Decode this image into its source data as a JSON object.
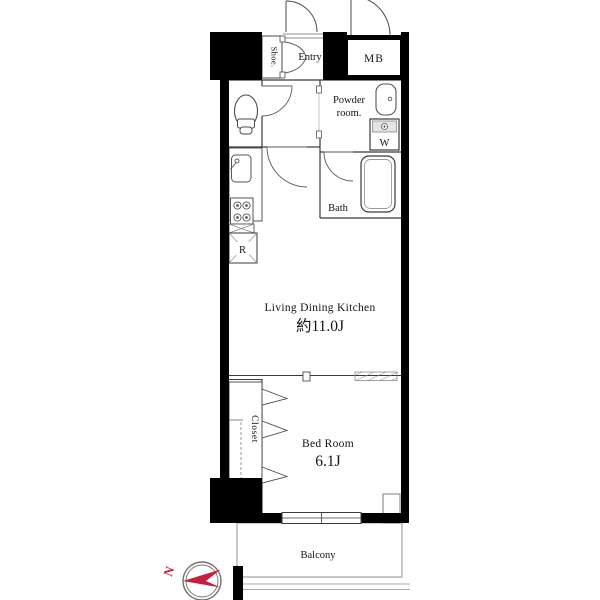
{
  "floor_plan": {
    "title": "apartment-floor-plan",
    "rooms": {
      "shoe": "Shoe.",
      "entry": "Entry",
      "meter_box": "MB",
      "powder_line1": "Powder",
      "powder_line2": "room.",
      "washer": "W",
      "bath": "Bath",
      "refrigerator": "R",
      "ldk_name": "Living Dining Kitchen",
      "ldk_size": "約11.0J",
      "bedroom_name": "Bed Room",
      "bedroom_size": "6.1J",
      "closet": "Closet",
      "balcony": "Balcony"
    },
    "compass": {
      "north_label": "N",
      "needle_color": "#c51f3f"
    },
    "colors": {
      "wall": "#000000",
      "thin_line": "#3a3a3a",
      "fixture_line": "#555555",
      "light_line": "#9b9b9b",
      "accent_red": "#c51f3f",
      "background": "#ffffff"
    }
  }
}
